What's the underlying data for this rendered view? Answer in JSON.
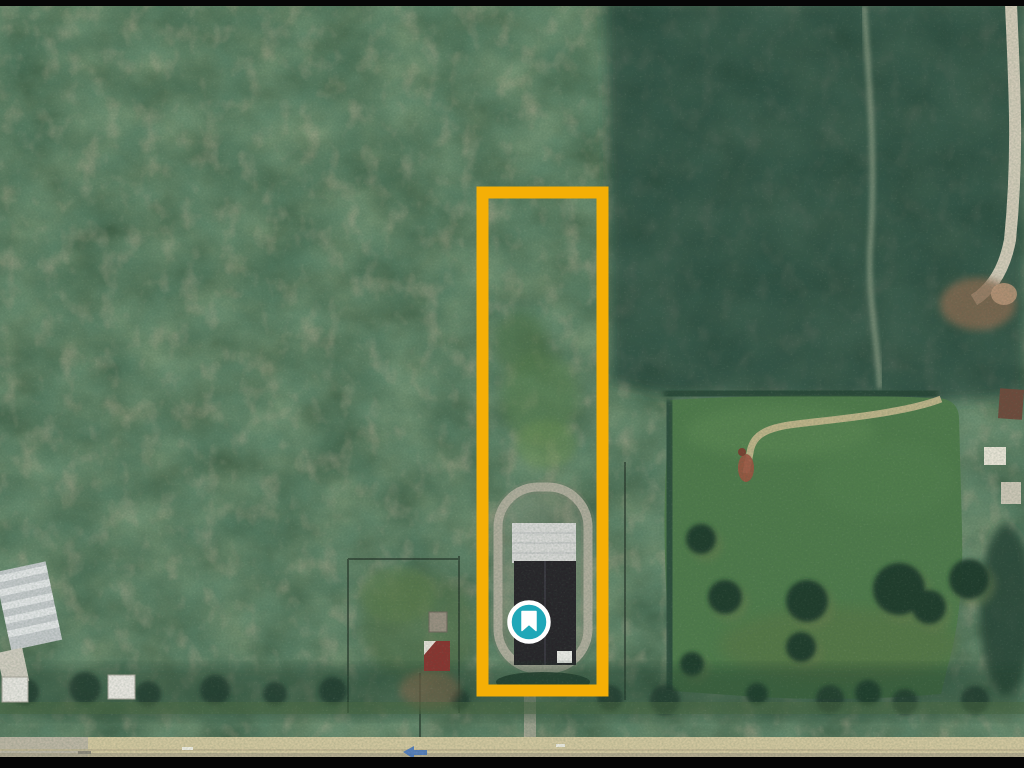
{
  "scene": {
    "type": "satellite-aerial-view",
    "description": "Satellite photo of rural forested land: dense mottled forest on the left, darker plantation rows top-right, an open pasture with scattered trees on the right, a tan road along the bottom, and a tall narrow land plot outlined in yellow containing a barn with a looped driveway.",
    "letterbox_color": "#060606",
    "colors": {
      "forest_base": "#3c5a42",
      "plantation_dark": "#1d3a35",
      "pasture_green": "#4f7a4b",
      "road_tan": "#d4c8a0"
    }
  },
  "annotation": {
    "highlight_rect": {
      "x": 482.5,
      "y": 192.5,
      "width": 120,
      "height": 498,
      "stroke_color": "#F5AF06",
      "stroke_width": 12
    },
    "marker": {
      "cx": 529,
      "cy": 622,
      "radius": 19.5,
      "ring_width": 4.5,
      "fill": "#1FA7B8",
      "ring_color": "#FFFFFF",
      "icon": "bookmark",
      "icon_color": "#FFFFFF"
    }
  }
}
